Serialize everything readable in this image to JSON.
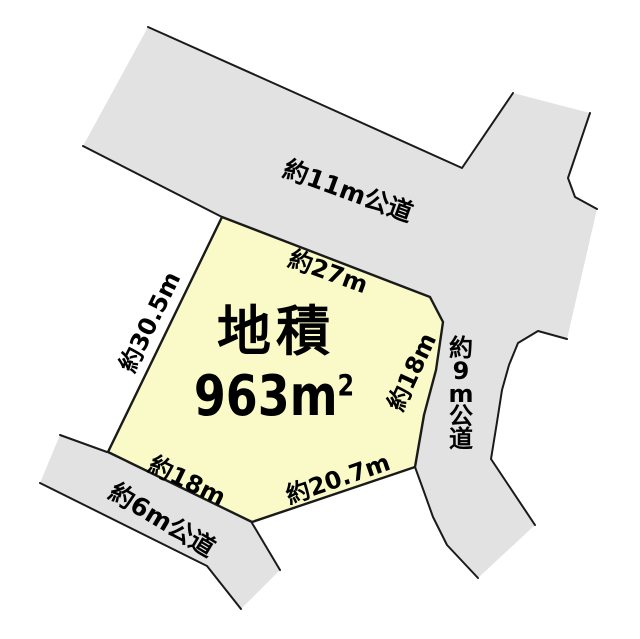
{
  "colors": {
    "background": "#FFFFFF",
    "road_fill": "#E2E2E2",
    "plot_fill": "#FAFAC8",
    "stroke": "#1A1A1A",
    "text": "#000000"
  },
  "plot": {
    "area_title": "地積",
    "area_value": "963m",
    "area_exponent": "2",
    "dim_top": "約27m",
    "dim_left": "約30.5m",
    "dim_right": "約18m",
    "dim_bottom_left": "約18m",
    "dim_bottom_right": "約20.7m"
  },
  "roads": {
    "top_label": "約11m公道",
    "right_label": "約9m公道",
    "bottom_left_label": "約6m公道"
  }
}
